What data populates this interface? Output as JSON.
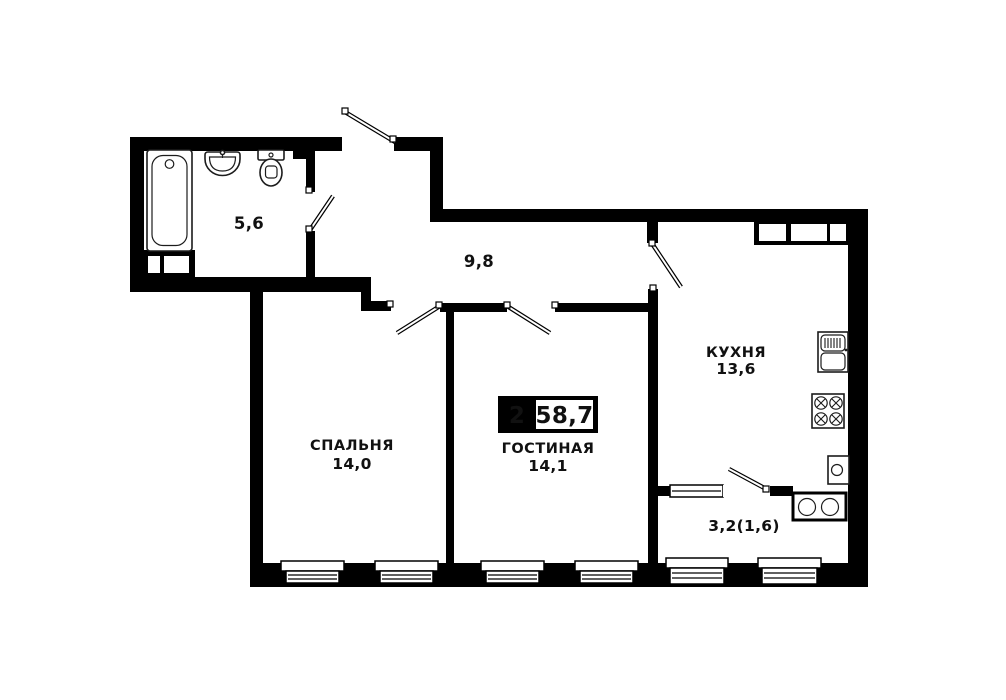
{
  "badge": {
    "room_count": "2",
    "total_area": "58,7"
  },
  "rooms": {
    "bathroom": {
      "area": "5,6"
    },
    "hallway": {
      "area": "9,8"
    },
    "bedroom": {
      "name": "СПАЛЬНЯ",
      "area": "14,0"
    },
    "living_room": {
      "name": "ГОСТИНАЯ",
      "area": "14,1"
    },
    "kitchen": {
      "name": "КУХНЯ",
      "area": "13,6"
    },
    "balcony": {
      "area": "3,2(1,6)"
    }
  },
  "fixtures": {
    "bathroom": [
      "bathtub-icon",
      "sink-icon",
      "toilet-icon"
    ],
    "kitchen": [
      "kitchen-sink-icon",
      "stove-icon",
      "water-heater-icon"
    ],
    "balcony": [
      "washing-machine-icon"
    ]
  },
  "colors": {
    "wall": "#000000",
    "floor": "#ffffff",
    "text": "#111111"
  }
}
